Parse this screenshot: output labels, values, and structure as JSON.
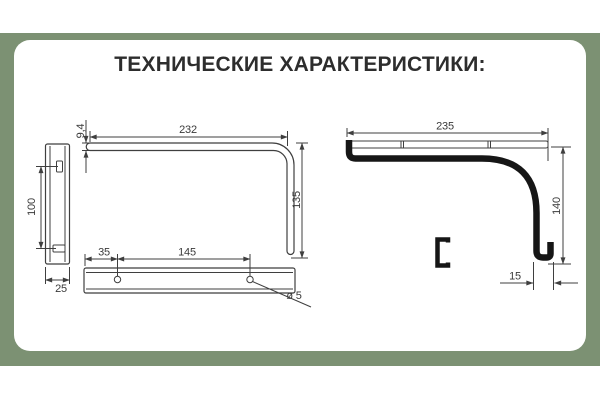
{
  "title": "ТЕХНИЧЕСКИЕ ХАРАКТЕРИСТИКИ:",
  "colors": {
    "background_band": "#7C9173",
    "card": "#FFFFFF",
    "line": "#3F3F3F",
    "thick_line": "#161616",
    "text": "#2D2D2D"
  },
  "views": {
    "wall_plate_side": {
      "slot_spacing": "100",
      "width": "25"
    },
    "bracket_front": {
      "arm_length": "232",
      "arm_thickness": "9,4",
      "leg_height": "135"
    },
    "mount_bar": {
      "edge_to_hole": "35",
      "hole_spacing": "145",
      "hole_diameter": "ø 5"
    },
    "bracket_side": {
      "length": "235",
      "height": "140",
      "hook": "15"
    }
  }
}
